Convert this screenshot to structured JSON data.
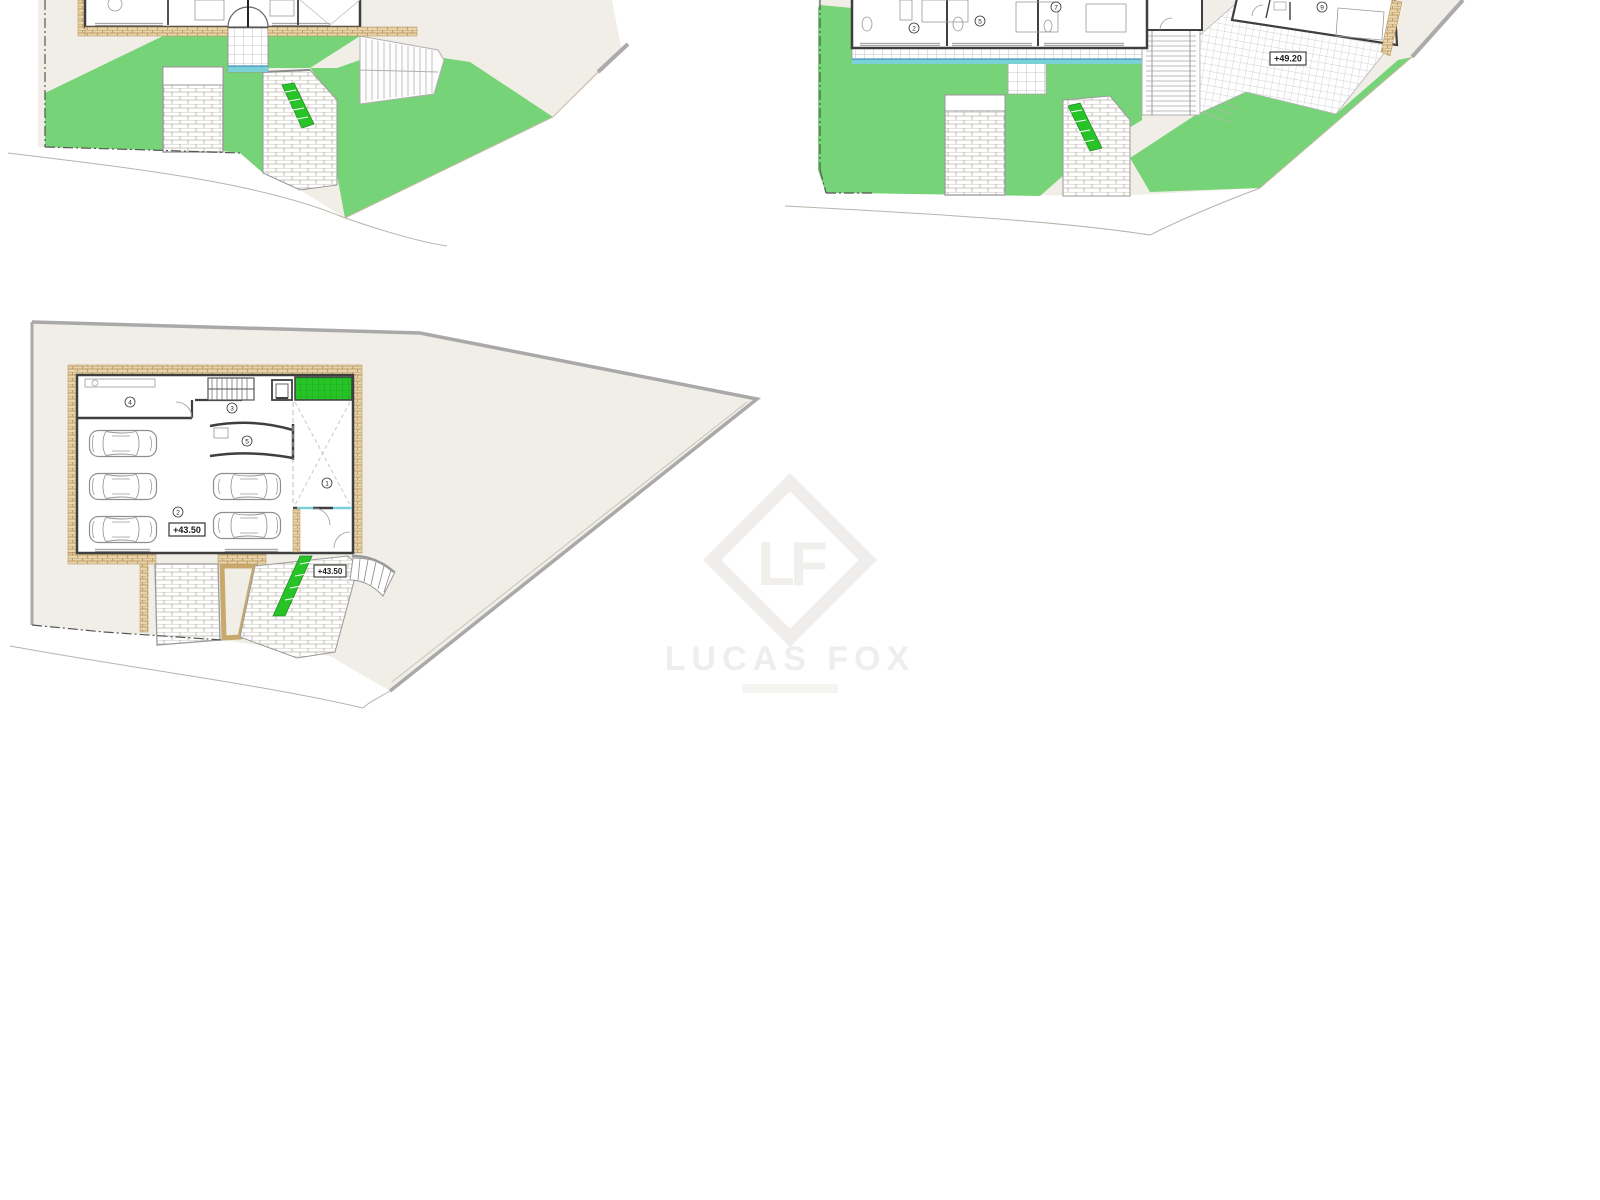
{
  "sheet": {
    "type": "architectural floor plan sheet",
    "background": "#ffffff"
  },
  "colors": {
    "site": "#f0eee7",
    "grass": "#77d377",
    "bright_green": "#27c427",
    "tan_brick": "#e8d4aa",
    "tan_line": "#b38d58",
    "wall": "#3f3f3f",
    "path_gray": "#9a9a9a",
    "pool_blue": "#7cd0d8",
    "boundary": "#a9a9a9",
    "watermark": "#efeeec"
  },
  "watermark": {
    "monogram": "LF",
    "name": "LUCAS FOX"
  },
  "plans": {
    "upper_left": {
      "description_rooms": []
    },
    "upper_right": {
      "elevation_label": "+49.20",
      "rooms": [
        "2",
        "5",
        "7",
        "9"
      ]
    },
    "basement": {
      "elevation_label_interior": "+43.50",
      "elevation_label_entry": "+43.50",
      "rooms": [
        "1",
        "2",
        "3",
        "4",
        "5"
      ],
      "cars": 5
    }
  }
}
